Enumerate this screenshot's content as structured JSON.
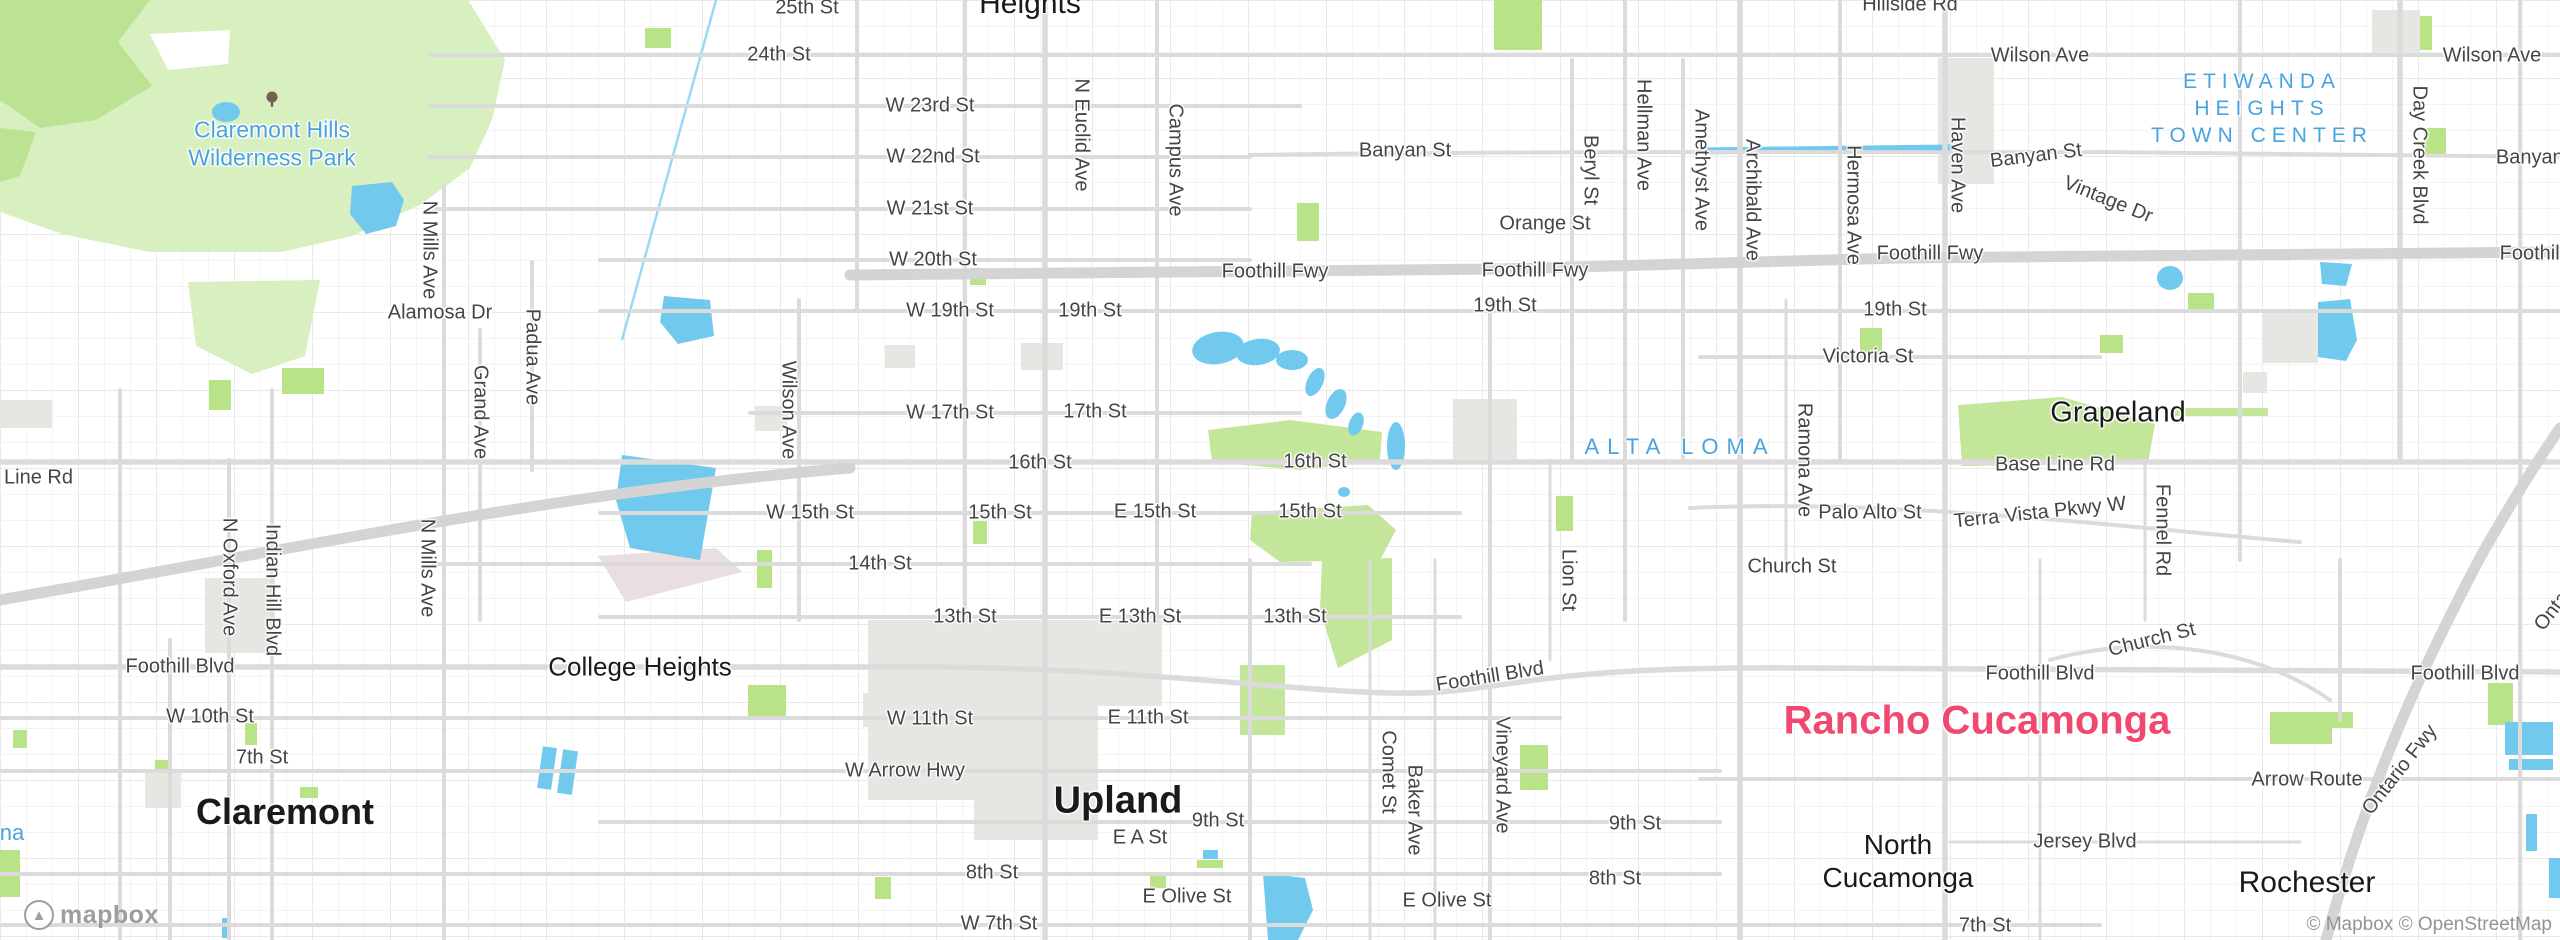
{
  "map": {
    "palette": {
      "background": "#ffffff",
      "road": "#dbdbdb",
      "freeway": "#d4d4d4",
      "park_light": "#d8efbf",
      "park_dark": "#bce393",
      "park_bright": "#b9e387",
      "water": "#72c9ee",
      "urban": "#e8e6e3",
      "railyard": "#eadfe0",
      "street_label": "#454545",
      "city_label": "#1a1a1a",
      "area_label_blue": "#49a3dc",
      "city_highlight_pink": "#f0486f",
      "attribution_gray": "#949494"
    },
    "attribution": {
      "logo_text": "mapbox",
      "copyright": "© Mapbox © OpenStreetMap"
    },
    "tree_icon": {
      "x": 272,
      "y": 100
    },
    "labels": {
      "streets": [
        {
          "t": "25th St",
          "x": 807,
          "y": 8
        },
        {
          "t": "24th St",
          "x": 779,
          "y": 55
        },
        {
          "t": "W 23rd St",
          "x": 930,
          "y": 106
        },
        {
          "t": "W 22nd St",
          "x": 933,
          "y": 157
        },
        {
          "t": "W 21st St",
          "x": 930,
          "y": 209
        },
        {
          "t": "W 20th St",
          "x": 933,
          "y": 260
        },
        {
          "t": "W 19th St",
          "x": 950,
          "y": 311
        },
        {
          "t": "19th St",
          "x": 1090,
          "y": 311
        },
        {
          "t": "19th St",
          "x": 1505,
          "y": 306
        },
        {
          "t": "19th St",
          "x": 1895,
          "y": 310
        },
        {
          "t": "Victoria St",
          "x": 1868,
          "y": 357
        },
        {
          "t": "Orange St",
          "x": 1545,
          "y": 224
        },
        {
          "t": "Banyan St",
          "x": 1405,
          "y": 151
        },
        {
          "t": "Banyan St",
          "x": 2036,
          "y": 156,
          "r": -7
        },
        {
          "t": "Banyan St",
          "x": 2542,
          "y": 158
        },
        {
          "t": "Hillside Rd",
          "x": 1910,
          "y": 5
        },
        {
          "t": "Wilson Ave",
          "x": 2040,
          "y": 56
        },
        {
          "t": "Wilson Ave",
          "x": 2492,
          "y": 56
        },
        {
          "t": "Vintage Dr",
          "x": 2108,
          "y": 200,
          "r": 22
        },
        {
          "t": "Foothill Fwy",
          "x": 1275,
          "y": 272
        },
        {
          "t": "Foothill Fwy",
          "x": 1535,
          "y": 271
        },
        {
          "t": "Foothill Fwy",
          "x": 1930,
          "y": 254
        },
        {
          "t": "Foothill Fwy",
          "x": 2553,
          "y": 254
        },
        {
          "t": "Alamosa Dr",
          "x": 440,
          "y": 313
        },
        {
          "t": "W 17th St",
          "x": 950,
          "y": 413
        },
        {
          "t": "17th St",
          "x": 1095,
          "y": 412
        },
        {
          "t": "16th St",
          "x": 1040,
          "y": 463
        },
        {
          "t": "16th St",
          "x": 1315,
          "y": 462
        },
        {
          "t": "W 15th St",
          "x": 810,
          "y": 513
        },
        {
          "t": "15th St",
          "x": 1000,
          "y": 513
        },
        {
          "t": "E 15th St",
          "x": 1155,
          "y": 512
        },
        {
          "t": "15th St",
          "x": 1310,
          "y": 512
        },
        {
          "t": "14th St",
          "x": 880,
          "y": 564
        },
        {
          "t": "13th St",
          "x": 965,
          "y": 617
        },
        {
          "t": "E 13th St",
          "x": 1140,
          "y": 617
        },
        {
          "t": "13th St",
          "x": 1295,
          "y": 617
        },
        {
          "t": "Line Rd",
          "x": 4,
          "y": 478,
          "a": "l"
        },
        {
          "t": "Base Line Rd",
          "x": 2055,
          "y": 465
        },
        {
          "t": "Terra Vista Pkwy W",
          "x": 2040,
          "y": 513,
          "r": -6
        },
        {
          "t": "Palo Alto St",
          "x": 1870,
          "y": 513
        },
        {
          "t": "Church St",
          "x": 1792,
          "y": 567
        },
        {
          "t": "Church St",
          "x": 2152,
          "y": 640,
          "r": -14
        },
        {
          "t": "Foothill Blvd",
          "x": 180,
          "y": 667
        },
        {
          "t": "Foothill Blvd",
          "x": 1490,
          "y": 677,
          "r": -9
        },
        {
          "t": "Foothill Blvd",
          "x": 2040,
          "y": 674
        },
        {
          "t": "Foothill Blvd",
          "x": 2465,
          "y": 674
        },
        {
          "t": "W 10th St",
          "x": 210,
          "y": 717
        },
        {
          "t": "7th St",
          "x": 262,
          "y": 758
        },
        {
          "t": "W 11th St",
          "x": 930,
          "y": 719
        },
        {
          "t": "E 11th St",
          "x": 1148,
          "y": 718
        },
        {
          "t": "W Arrow Hwy",
          "x": 905,
          "y": 771
        },
        {
          "t": "9th St",
          "x": 1218,
          "y": 821
        },
        {
          "t": "9th St",
          "x": 1635,
          "y": 824
        },
        {
          "t": "E A St",
          "x": 1140,
          "y": 838
        },
        {
          "t": "8th St",
          "x": 992,
          "y": 873
        },
        {
          "t": "8th St",
          "x": 1615,
          "y": 879
        },
        {
          "t": "E Olive St",
          "x": 1187,
          "y": 897
        },
        {
          "t": "E Olive St",
          "x": 1447,
          "y": 901
        },
        {
          "t": "W 7th St",
          "x": 999,
          "y": 924
        },
        {
          "t": "7th St",
          "x": 1985,
          "y": 926
        },
        {
          "t": "Arrow Route",
          "x": 2307,
          "y": 780
        },
        {
          "t": "Jersey Blvd",
          "x": 2085,
          "y": 842
        },
        {
          "t": "Ontario Fwy",
          "x": 2400,
          "y": 770,
          "r": -52
        },
        {
          "t": "Ontario Fwy",
          "x": 2572,
          "y": 586,
          "r": -52
        }
      ],
      "vertical_streets": [
        {
          "t": "N Euclid Ave",
          "x": 1081,
          "y": 135
        },
        {
          "t": "Campus Ave",
          "x": 1175,
          "y": 160
        },
        {
          "t": "Beryl St",
          "x": 1590,
          "y": 170
        },
        {
          "t": "Hellman Ave",
          "x": 1643,
          "y": 135
        },
        {
          "t": "Amethyst Ave",
          "x": 1701,
          "y": 170
        },
        {
          "t": "Archibald Ave",
          "x": 1752,
          "y": 200
        },
        {
          "t": "Hermosa Ave",
          "x": 1853,
          "y": 205
        },
        {
          "t": "Haven Ave",
          "x": 1957,
          "y": 165
        },
        {
          "t": "Day Creek Blvd",
          "x": 2419,
          "y": 155
        },
        {
          "t": "Wilson Ave",
          "x": 788,
          "y": 410
        },
        {
          "t": "N Mills Ave",
          "x": 429,
          "y": 250
        },
        {
          "t": "N Mills Ave",
          "x": 427,
          "y": 568
        },
        {
          "t": "N Oxford Ave",
          "x": 229,
          "y": 577
        },
        {
          "t": "Indian Hill Blvd",
          "x": 272,
          "y": 590
        },
        {
          "t": "Grand Ave",
          "x": 480,
          "y": 412
        },
        {
          "t": "Padua Ave",
          "x": 532,
          "y": 357
        },
        {
          "t": "Ramona Ave",
          "x": 1804,
          "y": 460
        },
        {
          "t": "Lion St",
          "x": 1568,
          "y": 580
        },
        {
          "t": "Comet St",
          "x": 1388,
          "y": 772
        },
        {
          "t": "Baker Ave",
          "x": 1414,
          "y": 810
        },
        {
          "t": "Vineyard Ave",
          "x": 1502,
          "y": 775
        },
        {
          "t": "Fennel Rd",
          "x": 2162,
          "y": 530
        }
      ],
      "places": [
        {
          "t": "Heights",
          "x": 1030,
          "y": 4,
          "s": 30,
          "w": 500
        },
        {
          "t": "Claremont",
          "x": 285,
          "y": 812,
          "s": 36,
          "w": 700
        },
        {
          "t": "Upland",
          "x": 1118,
          "y": 801,
          "s": 38,
          "w": 700
        },
        {
          "t": "College Heights",
          "x": 640,
          "y": 667,
          "s": 26,
          "w": 400
        },
        {
          "t": "Grapeland",
          "x": 2118,
          "y": 413,
          "s": 29,
          "w": 500
        },
        {
          "t": "North",
          "x": 1898,
          "y": 845,
          "s": 28,
          "w": 500
        },
        {
          "t": "Cucamonga",
          "x": 1898,
          "y": 878,
          "s": 28,
          "w": 500
        },
        {
          "t": "Rochester",
          "x": 2307,
          "y": 883,
          "s": 30,
          "w": 500
        },
        {
          "t": "Rancho Cucamonga",
          "x": 1977,
          "y": 721,
          "s": 40,
          "w": 700,
          "c": "#f0486f"
        }
      ],
      "areas": [
        {
          "t": "Claremont Hills",
          "x": 272,
          "y": 130,
          "s": 23,
          "w": 500
        },
        {
          "t": "Wilderness Park",
          "x": 272,
          "y": 158,
          "s": 23,
          "w": 500
        },
        {
          "t": "ETIWANDA",
          "x": 2262,
          "y": 82,
          "s": 21,
          "w": 500,
          "ls": 6
        },
        {
          "t": "HEIGHTS",
          "x": 2262,
          "y": 109,
          "s": 21,
          "w": 500,
          "ls": 6
        },
        {
          "t": "TOWN CENTER",
          "x": 2262,
          "y": 136,
          "s": 21,
          "w": 500,
          "ls": 6
        },
        {
          "t": "ALTA LOMA",
          "x": 1680,
          "y": 447,
          "s": 22,
          "w": 500,
          "ls": 8
        },
        {
          "t": "na",
          "x": 12,
          "y": 833,
          "s": 22,
          "w": 500
        }
      ]
    }
  }
}
